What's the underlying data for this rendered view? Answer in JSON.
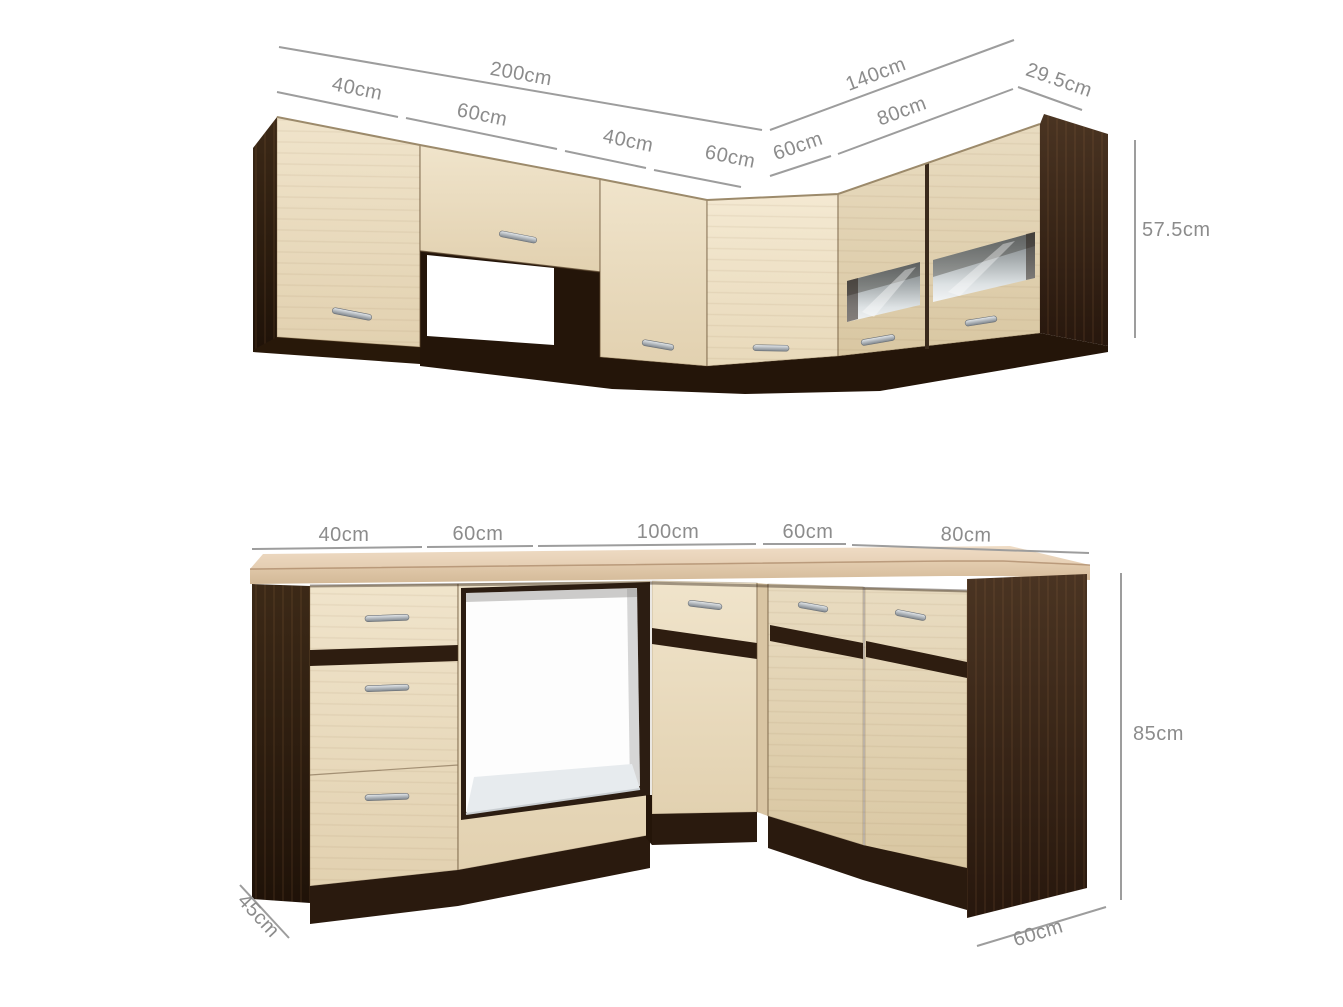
{
  "diagram": {
    "type": "kitchen-corner-cabinet-dimension-diagram",
    "upper_cabinets": {
      "total_left": "200cm",
      "left_segments": [
        "40cm",
        "60cm",
        "40cm",
        "60cm"
      ],
      "total_right": "140cm",
      "right_segments": [
        "60cm",
        "80cm"
      ],
      "depth": "29.5cm",
      "height": "57.5cm"
    },
    "base_cabinets": {
      "segments": [
        "40cm",
        "60cm",
        "100cm",
        "60cm",
        "80cm"
      ],
      "height": "85cm",
      "depth_left": "45cm",
      "depth_right": "60cm"
    },
    "colors": {
      "background": "#ffffff",
      "wood_light": "#e9dbc0",
      "wood_dark": "#34231a",
      "countertop": "#e8d4bb",
      "glass": "#cdd4d7",
      "handle": "#9aa1a7",
      "dimension_line": "#9d9d9d",
      "dimension_text": "#8c8c8c"
    }
  }
}
